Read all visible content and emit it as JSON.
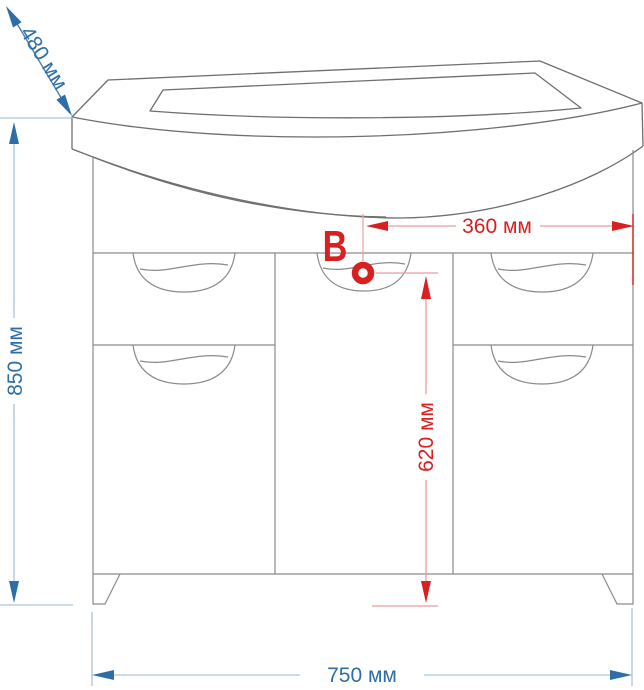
{
  "diagram": {
    "kind": "bathroom vanity cabinet dimension drawing",
    "labels": {
      "depth": "480 мм",
      "height": "850 мм",
      "drain_to_edge": "360 мм",
      "drain_height": "620 мм",
      "width": "750 мм",
      "drain_point": "B"
    },
    "colors": {
      "dimension_blue": "#2d6ea8",
      "dimension_blue_line": "#a9c4da",
      "dimension_red": "#d7201f",
      "dimension_red_line": "#eb9e9e",
      "cabinet_outline": "#8a8a8a",
      "sink_outline": "#6f6f6f",
      "background": "#ffffff"
    }
  }
}
